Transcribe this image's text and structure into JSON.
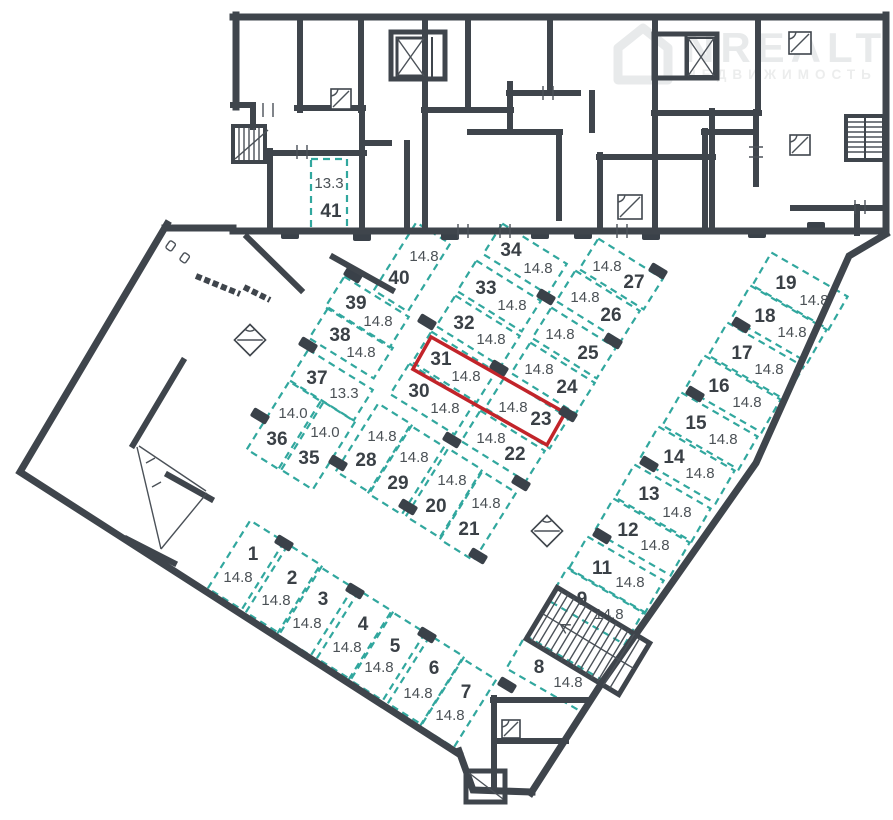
{
  "plan": {
    "watermark": {
      "brand": "NREALT",
      "subtitle": "НЕДВИЖИМОСТЬ"
    },
    "colors": {
      "wall": "#3f454c",
      "space_dash": "#31a79e",
      "highlight": "#c2242a",
      "number": "#3a4046",
      "area_label": "#4b5156",
      "watermark": "#e8eaeb"
    },
    "highlight": {
      "space_numbers": "31, 23",
      "cx": 489,
      "cy": 391,
      "w": 154,
      "h": 37,
      "angle": 29.5
    },
    "spaces": [
      {
        "num": "1",
        "area": "14.8",
        "cx": 246,
        "cy": 565,
        "w": 80,
        "h": 40,
        "angle": -58,
        "nx": 253,
        "ny": 553,
        "ax": 238,
        "ay": 577
      },
      {
        "num": "2",
        "area": "14.8",
        "cx": 284,
        "cy": 589,
        "w": 80,
        "h": 40,
        "angle": -58,
        "nx": 292,
        "ny": 577,
        "ax": 276,
        "ay": 600
      },
      {
        "num": "3",
        "area": "14.8",
        "cx": 315,
        "cy": 611,
        "w": 80,
        "h": 40,
        "angle": -58,
        "nx": 323,
        "ny": 598,
        "ax": 307,
        "ay": 623
      },
      {
        "num": "4",
        "area": "14.8",
        "cx": 355,
        "cy": 635,
        "w": 80,
        "h": 40,
        "angle": -58,
        "nx": 363,
        "ny": 623,
        "ax": 347,
        "ay": 647
      },
      {
        "num": "5",
        "area": "14.8",
        "cx": 387,
        "cy": 656,
        "w": 80,
        "h": 40,
        "angle": -58,
        "nx": 395,
        "ny": 645,
        "ax": 379,
        "ay": 667
      },
      {
        "num": "6",
        "area": "14.8",
        "cx": 426,
        "cy": 680,
        "w": 80,
        "h": 40,
        "angle": -58,
        "nx": 434,
        "ny": 667,
        "ax": 418,
        "ay": 693
      },
      {
        "num": "7",
        "area": "14.8",
        "cx": 458,
        "cy": 703,
        "w": 80,
        "h": 40,
        "angle": -58,
        "nx": 466,
        "ny": 691,
        "ax": 450,
        "ay": 715
      },
      {
        "num": "8",
        "area": "14.8",
        "cx": 554,
        "cy": 674,
        "w": 88,
        "h": 38,
        "angle": 30,
        "nx": 539,
        "ny": 666,
        "ax": 568,
        "ay": 682
      },
      {
        "num": "9",
        "area": "14.8",
        "cx": 596,
        "cy": 606,
        "w": 88,
        "h": 38,
        "angle": 30,
        "nx": 582,
        "ny": 598,
        "ax": 609,
        "ay": 614
      },
      {
        "num": "11",
        "area": "14.8",
        "cx": 616,
        "cy": 575,
        "w": 88,
        "h": 38,
        "angle": 30,
        "nx": 602,
        "ny": 567,
        "ax": 630,
        "ay": 582
      },
      {
        "num": "12",
        "area": "14.8",
        "cx": 642,
        "cy": 537,
        "w": 88,
        "h": 38,
        "angle": 30,
        "nx": 628,
        "ny": 529,
        "ax": 655,
        "ay": 545
      },
      {
        "num": "13",
        "area": "14.8",
        "cx": 663,
        "cy": 503,
        "w": 88,
        "h": 38,
        "angle": 30,
        "nx": 649,
        "ny": 493,
        "ax": 677,
        "ay": 512
      },
      {
        "num": "14",
        "area": "14.8",
        "cx": 687,
        "cy": 465,
        "w": 88,
        "h": 38,
        "angle": 30,
        "nx": 674,
        "ny": 456,
        "ax": 700,
        "ay": 473
      },
      {
        "num": "15",
        "area": "14.8",
        "cx": 710,
        "cy": 431,
        "w": 88,
        "h": 38,
        "angle": 30,
        "nx": 696,
        "ny": 422,
        "ax": 723,
        "ay": 439
      },
      {
        "num": "16",
        "area": "14.8",
        "cx": 733,
        "cy": 394,
        "w": 88,
        "h": 38,
        "angle": 30,
        "nx": 719,
        "ny": 385,
        "ax": 747,
        "ay": 402
      },
      {
        "num": "17",
        "area": "14.8",
        "cx": 756,
        "cy": 361,
        "w": 88,
        "h": 38,
        "angle": 30,
        "nx": 742,
        "ny": 352,
        "ax": 769,
        "ay": 369
      },
      {
        "num": "18",
        "area": "14.8",
        "cx": 779,
        "cy": 324,
        "w": 88,
        "h": 38,
        "angle": 30,
        "nx": 765,
        "ny": 315,
        "ax": 792,
        "ay": 332
      },
      {
        "num": "19",
        "area": "14.8",
        "cx": 800,
        "cy": 291,
        "w": 88,
        "h": 38,
        "angle": 30,
        "nx": 786,
        "ny": 282,
        "ax": 814,
        "ay": 300
      },
      {
        "num": "20",
        "area": "14.8",
        "cx": 444,
        "cy": 493,
        "w": 80,
        "h": 40,
        "angle": -58,
        "nx": 436,
        "ny": 505,
        "ax": 452,
        "ay": 480
      },
      {
        "num": "21",
        "area": "14.8",
        "cx": 478,
        "cy": 516,
        "w": 80,
        "h": 40,
        "angle": -58,
        "nx": 469,
        "ny": 528,
        "ax": 486,
        "ay": 503
      },
      {
        "num": "22",
        "area": "14.8",
        "cx": 503,
        "cy": 446,
        "w": 76,
        "h": 36,
        "angle": 32,
        "nx": 515,
        "ny": 453,
        "ax": 491,
        "ay": 438
      },
      {
        "num": "23",
        "area": "14.8",
        "cx": 527,
        "cy": 413,
        "w": 76,
        "h": 36,
        "angle": 32,
        "nx": 541,
        "ny": 418,
        "ax": 513,
        "ay": 407
      },
      {
        "num": "24",
        "area": "14.8",
        "cx": 553,
        "cy": 378,
        "w": 76,
        "h": 36,
        "angle": 32,
        "nx": 567,
        "ny": 386,
        "ax": 539,
        "ay": 369
      },
      {
        "num": "25",
        "area": "14.8",
        "cx": 574,
        "cy": 343,
        "w": 76,
        "h": 36,
        "angle": 32,
        "nx": 588,
        "ny": 352,
        "ax": 560,
        "ay": 334
      },
      {
        "num": "26",
        "area": "14.8",
        "cx": 598,
        "cy": 306,
        "w": 76,
        "h": 36,
        "angle": 32,
        "nx": 611,
        "ny": 314,
        "ax": 585,
        "ay": 297
      },
      {
        "num": "27",
        "area": "14.8",
        "cx": 621,
        "cy": 274,
        "w": 76,
        "h": 36,
        "angle": 32,
        "nx": 634,
        "ny": 281,
        "ax": 607,
        "ay": 266
      },
      {
        "num": "28",
        "area": "14.8",
        "cx": 374,
        "cy": 448,
        "w": 80,
        "h": 40,
        "angle": -58,
        "nx": 366,
        "ny": 459,
        "ax": 382,
        "ay": 436
      },
      {
        "num": "29",
        "area": "14.8",
        "cx": 406,
        "cy": 470,
        "w": 80,
        "h": 40,
        "angle": -58,
        "nx": 398,
        "ny": 482,
        "ax": 414,
        "ay": 457
      },
      {
        "num": "30",
        "area": "14.8",
        "cx": 432,
        "cy": 399,
        "w": 76,
        "h": 36,
        "angle": 32,
        "nx": 419,
        "ny": 390,
        "ax": 445,
        "ay": 408
      },
      {
        "num": "31",
        "area": "14.8",
        "cx": 454,
        "cy": 367,
        "w": 76,
        "h": 36,
        "angle": 32,
        "nx": 441,
        "ny": 358,
        "ax": 466,
        "ay": 376
      },
      {
        "num": "32",
        "area": "14.8",
        "cx": 478,
        "cy": 331,
        "w": 76,
        "h": 36,
        "angle": 32,
        "nx": 464,
        "ny": 322,
        "ax": 491,
        "ay": 339
      },
      {
        "num": "33",
        "area": "14.8",
        "cx": 499,
        "cy": 296,
        "w": 76,
        "h": 36,
        "angle": 32,
        "nx": 486,
        "ny": 287,
        "ax": 512,
        "ay": 305
      },
      {
        "num": "34",
        "area": "14.8",
        "cx": 525,
        "cy": 259,
        "w": 76,
        "h": 36,
        "angle": 32,
        "nx": 511,
        "ny": 249,
        "ax": 538,
        "ay": 268
      },
      {
        "num": "35",
        "area": "14.0",
        "cx": 317,
        "cy": 445,
        "w": 80,
        "h": 40,
        "angle": -58,
        "nx": 309,
        "ny": 457,
        "ax": 325,
        "ay": 432
      },
      {
        "num": "36",
        "area": "14.0",
        "cx": 285,
        "cy": 426,
        "w": 80,
        "h": 40,
        "angle": -58,
        "nx": 277,
        "ny": 438,
        "ax": 293,
        "ay": 413
      },
      {
        "num": "37",
        "area": "13.3",
        "cx": 331,
        "cy": 385,
        "w": 76,
        "h": 36,
        "angle": 32,
        "nx": 317,
        "ny": 377,
        "ax": 344,
        "ay": 393
      },
      {
        "num": "38",
        "area": "14.8",
        "cx": 351,
        "cy": 343,
        "w": 76,
        "h": 36,
        "angle": 32,
        "nx": 340,
        "ny": 334,
        "ax": 361,
        "ay": 352
      },
      {
        "num": "39",
        "area": "14.8",
        "cx": 367,
        "cy": 312,
        "w": 76,
        "h": 36,
        "angle": 32,
        "nx": 356,
        "ny": 302,
        "ax": 378,
        "ay": 321
      },
      {
        "num": "40",
        "area": "14.8",
        "cx": 412,
        "cy": 267,
        "w": 80,
        "h": 40,
        "angle": -58,
        "nx": 399,
        "ny": 277,
        "ax": 424,
        "ay": 256
      },
      {
        "num": "41",
        "area": "13.3",
        "cx": 329,
        "cy": 194,
        "w": 36,
        "h": 70,
        "angle": 0,
        "nx": 331,
        "ny": 210,
        "ax": 329,
        "ay": 183
      }
    ],
    "columns": [
      {
        "x": 290,
        "y": 234,
        "a": 0
      },
      {
        "x": 362,
        "y": 236,
        "a": 0
      },
      {
        "x": 450,
        "y": 235,
        "a": 0
      },
      {
        "x": 540,
        "y": 234,
        "a": 0
      },
      {
        "x": 583,
        "y": 234,
        "a": 0
      },
      {
        "x": 651,
        "y": 235,
        "a": 0
      },
      {
        "x": 757,
        "y": 233,
        "a": 0
      },
      {
        "x": 816,
        "y": 227,
        "a": 0
      },
      {
        "x": 353,
        "y": 275,
        "a": 31
      },
      {
        "x": 427,
        "y": 322,
        "a": 31
      },
      {
        "x": 499,
        "y": 368,
        "a": 31
      },
      {
        "x": 568,
        "y": 414,
        "a": 31
      },
      {
        "x": 546,
        "y": 297,
        "a": 31
      },
      {
        "x": 613,
        "y": 341,
        "a": 31
      },
      {
        "x": 308,
        "y": 345,
        "a": 31
      },
      {
        "x": 260,
        "y": 416,
        "a": 31
      },
      {
        "x": 338,
        "y": 463,
        "a": 31
      },
      {
        "x": 284,
        "y": 543,
        "a": 31
      },
      {
        "x": 355,
        "y": 591,
        "a": 31
      },
      {
        "x": 427,
        "y": 635,
        "a": 31
      },
      {
        "x": 478,
        "y": 556,
        "a": 31
      },
      {
        "x": 408,
        "y": 507,
        "a": 31
      },
      {
        "x": 452,
        "y": 440,
        "a": 31
      },
      {
        "x": 521,
        "y": 483,
        "a": 31
      },
      {
        "x": 658,
        "y": 271,
        "a": 31
      },
      {
        "x": 741,
        "y": 325,
        "a": 31
      },
      {
        "x": 695,
        "y": 394,
        "a": 31
      },
      {
        "x": 649,
        "y": 464,
        "a": 31
      },
      {
        "x": 602,
        "y": 536,
        "a": 31
      },
      {
        "x": 507,
        "y": 685,
        "a": 31
      }
    ],
    "symbols": [
      {
        "x": 250,
        "y": 340,
        "s": 22,
        "a": 45
      },
      {
        "x": 547,
        "y": 531,
        "s": 22,
        "a": 45
      },
      {
        "x": 341,
        "y": 99,
        "s": 20,
        "a": 0
      },
      {
        "x": 630,
        "y": 207,
        "s": 24,
        "a": 0
      },
      {
        "x": 800,
        "y": 43,
        "s": 22,
        "a": 0
      },
      {
        "x": 800,
        "y": 145,
        "s": 20,
        "a": 0
      },
      {
        "x": 511,
        "y": 729,
        "s": 18,
        "a": 0
      }
    ]
  }
}
